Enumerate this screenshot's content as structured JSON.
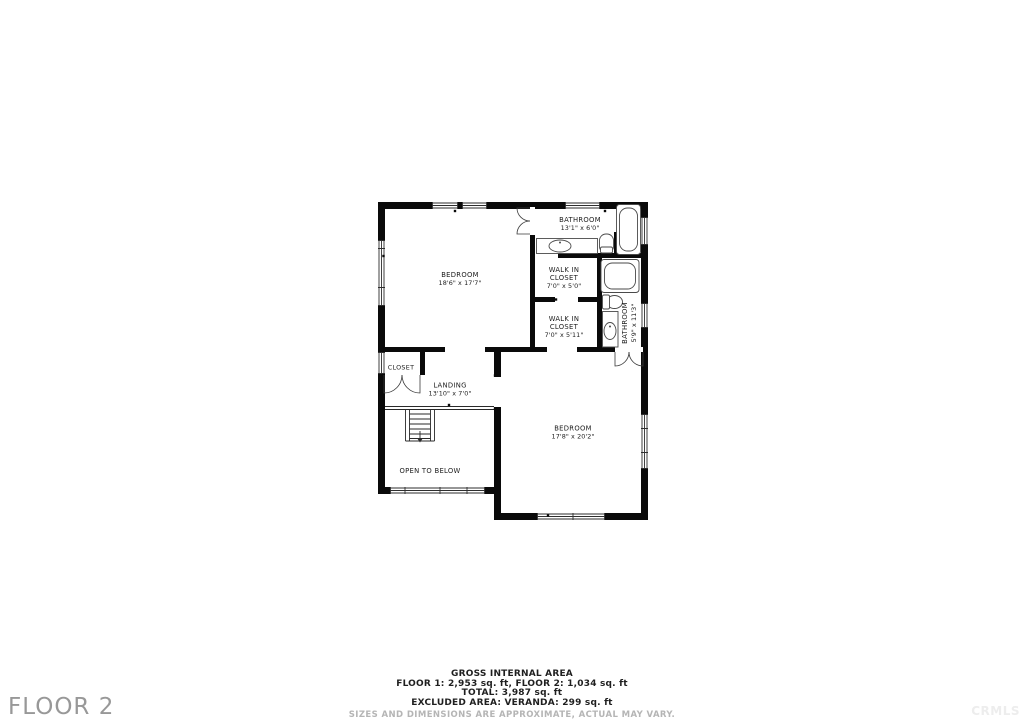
{
  "floor_label": "FLOOR 2",
  "watermark": "CRMLS",
  "rooms": {
    "bathroom1": {
      "name": "BATHROOM",
      "dims": "13'1\" x 6'0\""
    },
    "bedroom1": {
      "name": "BEDROOM",
      "dims": "18'6\" x 17'7\""
    },
    "walkin1": {
      "line1": "WALK IN",
      "line2": "CLOSET",
      "dims": "7'0\" x 5'0\""
    },
    "walkin2": {
      "line1": "WALK IN",
      "line2": "CLOSET",
      "dims": "7'0\" x 5'11\""
    },
    "bathroom2": {
      "name": "BATHROOM",
      "dims": "5'9\" x 11'3\""
    },
    "closet": {
      "name": "CLOSET"
    },
    "landing": {
      "name": "LANDING",
      "dims": "13'10\" x 7'0\""
    },
    "open_to_below": {
      "name": "OPEN TO BELOW"
    },
    "bedroom2": {
      "name": "BEDROOM",
      "dims": "17'8\" x 20'2\""
    }
  },
  "footer": {
    "title": "GROSS INTERNAL AREA",
    "line1": "FLOOR 1: 2,953 sq. ft, FLOOR 2: 1,034 sq. ft",
    "line2": "TOTAL: 3,987 sq. ft",
    "line3": "EXCLUDED AREA: VERANDA: 299 sq. ft",
    "disclaimer": "SIZES AND DIMENSIONS ARE APPROXIMATE, ACTUAL MAY VARY."
  },
  "icons": {
    "bathtub": "rounded-rect outline",
    "toilet": "tank + bowl outline",
    "sink": "oval in counter",
    "stairs": "parallel treads with down arrow",
    "door": "quarter-arc swing",
    "window": "triple thin lines in wall gap"
  },
  "colors": {
    "wall": "#0a0a0a",
    "label_text": "#1c1c1c",
    "footer_text": "#1f1f1f",
    "muted_text": "#b5b5b5",
    "floor_label": "#989898",
    "watermark": "#ededed"
  }
}
